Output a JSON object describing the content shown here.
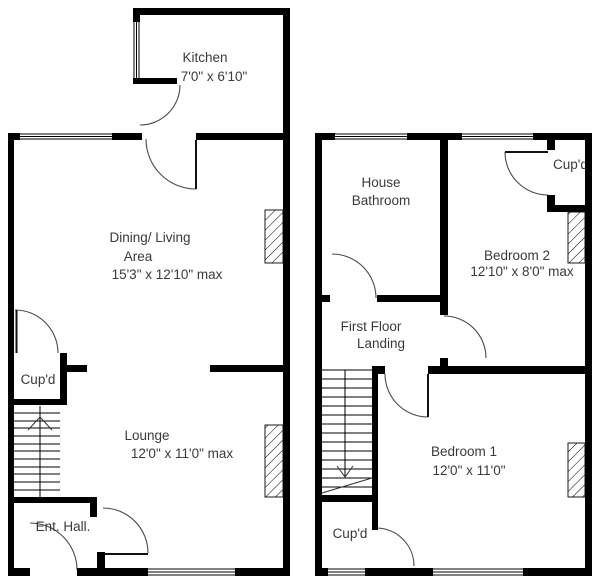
{
  "floorplan": {
    "colors": {
      "wall": "#000000",
      "background": "#ffffff",
      "text": "#3a3a3a",
      "door_arc": "#4a4a4a"
    },
    "ground_floor": {
      "rooms": {
        "kitchen": {
          "name": "Kitchen",
          "dims": "7'0\" x 6'10\""
        },
        "dining_living": {
          "name_line1": "Dining/ Living",
          "name_line2": "Area",
          "dims": "15'3\" x 12'10\" max"
        },
        "lounge": {
          "name": "Lounge",
          "dims": "12'0\" x 11'0\" max"
        },
        "cupboard": {
          "name": "Cup'd"
        },
        "entrance_hall": {
          "name": "Ent. Hall."
        }
      }
    },
    "first_floor": {
      "rooms": {
        "house_bathroom": {
          "name_line1": "House",
          "name_line2": "Bathroom"
        },
        "bedroom2": {
          "name": "Bedroom 2",
          "dims": "12'10\" x 8'0\" max"
        },
        "landing": {
          "name_line1": "First Floor",
          "name_line2": "Landing"
        },
        "bedroom1": {
          "name": "Bedroom 1",
          "dims": "12'0\" x 11'0\""
        },
        "cupboard_top": {
          "name": "Cup'd"
        },
        "cupboard_bottom": {
          "name": "Cup'd"
        }
      }
    }
  }
}
